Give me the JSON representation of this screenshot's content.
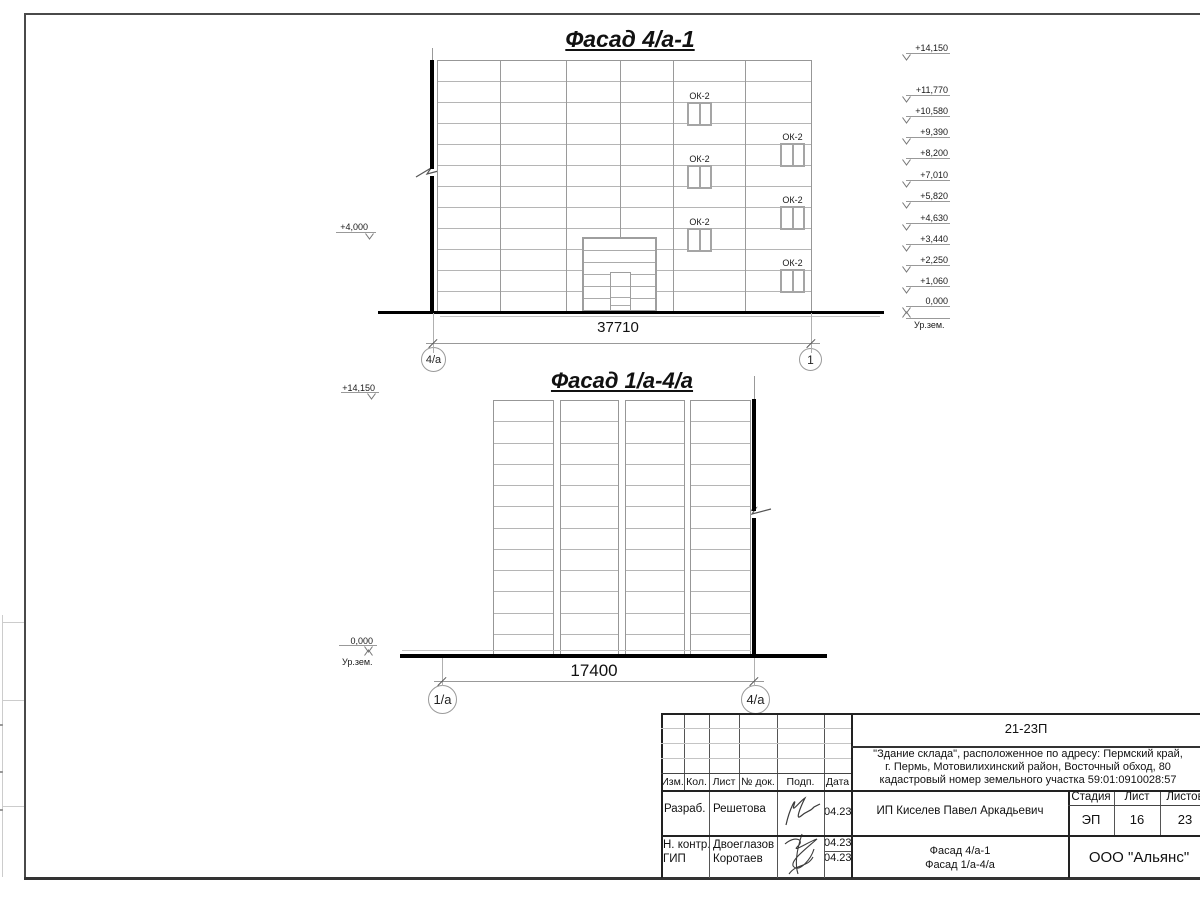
{
  "drawing": {
    "facade1": {
      "title": "Фасад 4/а-1",
      "dimension": "37710",
      "axis_left": "4/а",
      "axis_right": "1",
      "window_label": "ОК-2",
      "left_elevation": "+4,000",
      "right_elevations": [
        "+14,150",
        "+11,770",
        "+10,580",
        "+9,390",
        "+8,200",
        "+7,010",
        "+5,820",
        "+4,630",
        "+3,440",
        "+2,250",
        "+1,060",
        "0,000"
      ],
      "ground_level_label": "Ур.зем."
    },
    "facade2": {
      "title": "Фасад 1/а-4/а",
      "dimension": "17400",
      "axis_left": "1/а",
      "axis_right": "4/а",
      "top_elevation": "+14,150",
      "zero_elevation": "0,000",
      "ground_level_label": "Ур.зем."
    }
  },
  "titleblock": {
    "doc_number": "21-23П",
    "description_lines": [
      "\"Здание склада\", расположенное по адресу: Пермский край,",
      "г. Пермь, Мотовилихинский район, Восточный обход, 80",
      "кадастровый номер земельного участка 59:01:0910028:57"
    ],
    "header_cols": [
      "Изм.",
      "Кол.",
      "Лист",
      "№ док.",
      "Подп.",
      "Дата"
    ],
    "signers": [
      {
        "role": "Разраб.",
        "name": "Решетова",
        "date": "04.23"
      },
      {
        "role": "Н. контр.",
        "name": "Двоеглазов",
        "date": "04.23"
      },
      {
        "role": "ГИП",
        "name": "Коротаев",
        "date": "04.23"
      }
    ],
    "client": "ИП Киселев Павел Аркадьевич",
    "stage_label": "Стадия",
    "sheet_label": "Лист",
    "sheets_label": "Листов",
    "stage_value": "ЭП",
    "sheet_value": "16",
    "sheets_value": "23",
    "sheet_titles": [
      "Фасад 4/а-1",
      "Фасад 1/а-4/а"
    ],
    "company": "ООО \"Альянс\""
  },
  "colors": {
    "thick": "#000000",
    "thin": "#999999",
    "band": "#b5b5b5",
    "frame": "#4a4a4a"
  }
}
